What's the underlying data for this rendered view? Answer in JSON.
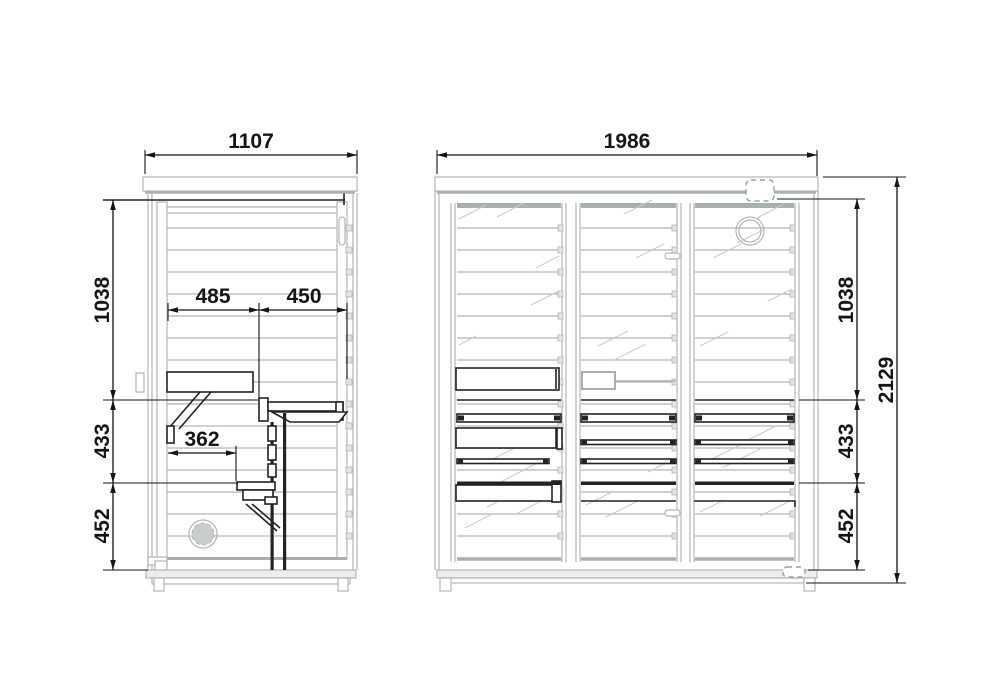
{
  "drawing_type": "sauna-technical-drawing",
  "dims": {
    "side_width": "1107",
    "front_width": "1986",
    "upper_height": "1038",
    "middle_height": "433",
    "lower_height": "452",
    "overall_height": "2129",
    "bench_back_depth": "485",
    "bench_front_depth": "450",
    "step_depth": "362"
  },
  "colors": {
    "dimension_lines": "#151515",
    "structure_lines": "#b2b6b8",
    "furniture_lines": "#232323",
    "glass_reflection": "#c9cdce",
    "background": "#ffffff"
  },
  "icons": {
    "heater_fan": "circular fan / vent on rear wall",
    "roof_vent": "dashed roof vent",
    "foot_adjuster": "dashed adjustable foot",
    "door_handle": "vertical door handle"
  }
}
